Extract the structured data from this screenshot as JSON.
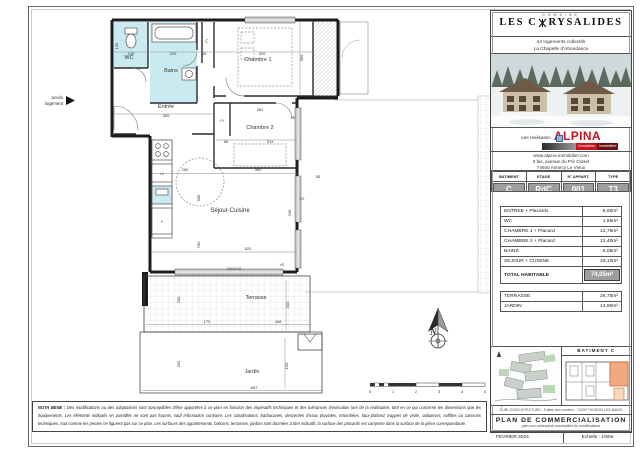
{
  "plan": {
    "access_label_line1": "accès",
    "access_label_line2": "logement",
    "compass_label": "N",
    "rooms": [
      {
        "label": "WC",
        "x": 99,
        "y": 51,
        "cls": "room-label"
      },
      {
        "label": "Bains",
        "x": 141,
        "y": 64,
        "cls": "room-label"
      },
      {
        "label": "Chambre 1",
        "x": 228,
        "y": 53,
        "cls": "room-label"
      },
      {
        "label": "Pl",
        "x": 178,
        "y": 33,
        "cls": "anno-label",
        "r": -90
      },
      {
        "label": "Entrée",
        "x": 136,
        "y": 100,
        "cls": "room-label"
      },
      {
        "label": "Pl",
        "x": 192,
        "y": 114,
        "cls": "anno-label"
      },
      {
        "label": "Chambre 2",
        "x": 230,
        "y": 121,
        "cls": "room-label"
      },
      {
        "label": "Séjour-Cuisine",
        "x": 200,
        "y": 204,
        "cls": "big-room-label"
      },
      {
        "label": "Terrasse",
        "x": 226,
        "y": 291,
        "cls": "room-label"
      },
      {
        "label": "Jardin",
        "x": 222,
        "y": 365,
        "cls": "room-label"
      }
    ],
    "dims": [
      {
        "v": "135",
        "x": 88,
        "y": 38,
        "r": -90
      },
      {
        "v": "130",
        "x": 101,
        "y": 47
      },
      {
        "v": "210",
        "x": 143,
        "y": 47
      },
      {
        "v": "65",
        "x": 174,
        "y": 47
      },
      {
        "v": "320",
        "x": 232,
        "y": 47
      },
      {
        "v": "300",
        "x": 273,
        "y": 50,
        "r": -90
      },
      {
        "v": "300",
        "x": 136,
        "y": 109
      },
      {
        "v": "381",
        "x": 230,
        "y": 103
      },
      {
        "v": "65",
        "x": 196,
        "y": 135
      },
      {
        "v": "311",
        "x": 240,
        "y": 135
      },
      {
        "v": "260",
        "x": 155,
        "y": 163
      },
      {
        "v": "360",
        "x": 228,
        "y": 163
      },
      {
        "v": "905",
        "x": 170,
        "y": 190,
        "r": -90
      },
      {
        "v": "239",
        "x": 261,
        "y": 205,
        "r": -90
      },
      {
        "v": "700",
        "x": 170,
        "y": 237,
        "r": -90
      },
      {
        "v": "520",
        "x": 218,
        "y": 242
      },
      {
        "v": "55",
        "x": 288,
        "y": 170
      },
      {
        "v": "200",
        "x": 150,
        "y": 292,
        "r": -90
      },
      {
        "v": "170",
        "x": 177,
        "y": 315
      },
      {
        "v": "408",
        "x": 248,
        "y": 315
      },
      {
        "v": "300",
        "x": 259,
        "y": 297,
        "r": -90
      },
      {
        "v": "295",
        "x": 150,
        "y": 356,
        "r": -90
      },
      {
        "v": "667",
        "x": 224,
        "y": 381
      },
      {
        "v": "150",
        "x": 258,
        "y": 358,
        "r": -90
      }
    ],
    "annotations": [
      {
        "v": "LV",
        "x": 132,
        "y": 167
      },
      {
        "v": "F",
        "x": 132,
        "y": 215
      },
      {
        "v": "VR",
        "x": 263,
        "y": 111
      },
      {
        "v": "VS",
        "x": 272,
        "y": 192
      },
      {
        "v": "VS",
        "x": 252,
        "y": 258
      },
      {
        "v": "290X215",
        "x": 204,
        "y": 262
      }
    ],
    "scale_ticks": [
      "0",
      "1",
      "2",
      "3",
      "4",
      "5"
    ]
  },
  "title_block": {
    "domaine": "DOMAINE",
    "project_name_prefix": "LES C",
    "project_name_suffix": "RYSALIDES",
    "subtitle_line1": "44 logements collectifs",
    "subtitle_line2": "La Chapelle d'Abondance",
    "realisation": "une réalisation",
    "brand": "ALPINA",
    "brand_sub1": "Conception",
    "brand_sub2": "Immobilière",
    "website": "www.alpina-immobilier.com",
    "address_line1": "5 bis, avenue du Pré Closet",
    "address_line2": "74940 Annecy Le Vieux",
    "info_table": {
      "headers": [
        "BATIMENT",
        "ETAGE",
        "N° APPART.",
        "TYPE"
      ],
      "values": [
        "C",
        "RdC",
        "001",
        "T3"
      ]
    },
    "areas": {
      "rows": [
        {
          "label": "ENTREE + Placards",
          "value": "8,90m²"
        },
        {
          "label": "WC",
          "value": "1,85m²"
        },
        {
          "label": "CHAMBRE 1 + Placard",
          "value": "12,75m²"
        },
        {
          "label": "CHAMBRE 2 + Placard",
          "value": "12,40m²"
        },
        {
          "label": "BAINS",
          "value": "5,05m²"
        },
        {
          "label": "SEJOUR + CUISINE",
          "value": "33,10m²"
        }
      ],
      "total_label": "TOTAL HABITABLE",
      "total_value": "74,05m²"
    },
    "outdoor_rows": [
      {
        "label": "TERRASSE",
        "value": "26,75m²"
      },
      {
        "label": "JARDIN",
        "value": "14,80m²"
      }
    ],
    "key_plan_title": "BATIMENT C",
    "architect_line": "EURL D'ARCHITECTURE - 5 allée des moulins - 74200 THONON-LES-BAINS",
    "plan_box": {
      "title": "PLAN DE COMMERCIALISATION",
      "subtitle": "plan non contractuel susceptible de modifications",
      "date": "FEVRIER 2024",
      "scale": "Echelle : 1/50e"
    }
  },
  "nota": {
    "label": "NOTA BENE :",
    "line1": "Des modifications ou des adaptations sont susceptibles d'être apportées à ce plan en fonction des impératifs techniques et des tolérances d'exécution lors de la réalisation, tant en ce qui concerne les dimensions que",
    "line2": "les équipements. Les éléments indiqués en pointillés ne sont pas fournis, sauf information contraire. Les canalisations, barbacanes, descentes d'eaux pluviales, retombées, faux-plafond, trappes de visite, radiateurs, soffites ou caissons",
    "line3": "techniques, tout comme les pentes ne figurent pas sur ce plan. Les surfaces des appartements, balcons, terrasses, jardins sont données à titre indicatif, la surface des placards est comprise dans la surface de la pièce correspondante."
  }
}
